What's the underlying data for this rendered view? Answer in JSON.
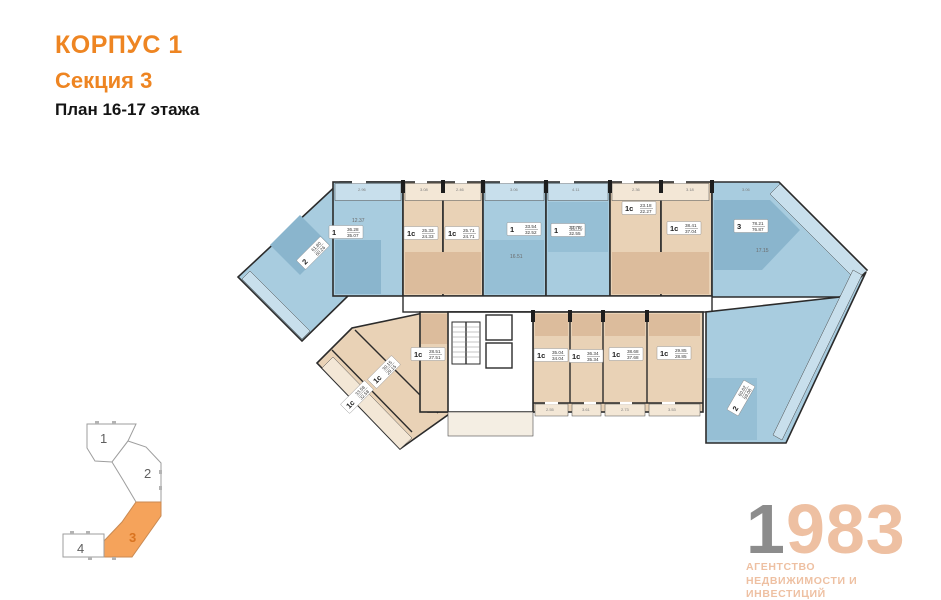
{
  "header": {
    "line1": "КОРПУС 1",
    "line2": "Секция 3",
    "line3": "План 16-17 этажа"
  },
  "colors": {
    "accent_orange": "#EE8522",
    "apartment_blue": "#A8CCDF",
    "apartment_beige": "#E9D2B6",
    "wall": "#2B2B2B",
    "minimap_active_orange": "#F5A35B",
    "logo_gray": "#8C8C8C",
    "logo_peach": "#EEC0A2"
  },
  "plan": {
    "apartments": [
      {
        "type": "2",
        "area_total": "61.80",
        "area_living": "60.26",
        "color": "blue"
      },
      {
        "type": "1",
        "area_total": "36.28",
        "area_living": "35.07",
        "color": "blue"
      },
      {
        "type": "1с",
        "area_total": "25.33",
        "area_living": "24.33",
        "color": "beige"
      },
      {
        "type": "1с",
        "area_total": "25.71",
        "area_living": "24.71",
        "color": "beige"
      },
      {
        "type": "1",
        "area_total": "33.54",
        "area_living": "32.52",
        "color": "blue"
      },
      {
        "type": "1",
        "area_total": "33.76",
        "area_living": "32.55",
        "color": "blue"
      },
      {
        "type": "1с",
        "area_total": "23.18",
        "area_living": "22.27",
        "color": "beige"
      },
      {
        "type": "1с",
        "area_total": "38.41",
        "area_living": "37.04",
        "color": "beige"
      },
      {
        "type": "3",
        "area_total": "78.21",
        "area_living": "76.87",
        "color": "blue"
      },
      {
        "type": "1с",
        "area_total": "33.58",
        "area_living": "32.58",
        "color": "beige"
      },
      {
        "type": "1с",
        "area_total": "30.15",
        "area_living": "29.15",
        "color": "beige"
      },
      {
        "type": "1с",
        "area_total": "28.51",
        "area_living": "27.51",
        "color": "beige"
      },
      {
        "type": "1с",
        "area_total": "35.04",
        "area_living": "34.04",
        "color": "beige"
      },
      {
        "type": "1с",
        "area_total": "36.34",
        "area_living": "35.34",
        "color": "beige"
      },
      {
        "type": "1с",
        "area_total": "38.68",
        "area_living": "37.68",
        "color": "beige"
      },
      {
        "type": "1с",
        "area_total": "29.85",
        "area_living": "28.85",
        "color": "beige"
      },
      {
        "type": "2",
        "area_total": "60.62",
        "area_living": "59.08",
        "color": "blue"
      }
    ],
    "dimensions": [
      "2.96",
      "3.08",
      "2.46",
      "3.06",
      "4.11",
      "2.36",
      "3.18",
      "3.06",
      "2.55",
      "3.61",
      "2.73",
      "3.53"
    ],
    "room_areas": [
      "16.51",
      "10.76",
      "17.15",
      "12.37"
    ]
  },
  "minimap": {
    "sections": [
      {
        "label": "1",
        "active": false
      },
      {
        "label": "2",
        "active": false
      },
      {
        "label": "3",
        "active": true
      },
      {
        "label": "4",
        "active": false
      }
    ]
  },
  "logo": {
    "digit_gray": "1",
    "digits_accent": "983",
    "sub1": "АГЕНТСТВО",
    "sub2": "НЕДВИЖИМОСТИ И ИНВЕСТИЦИЙ"
  }
}
